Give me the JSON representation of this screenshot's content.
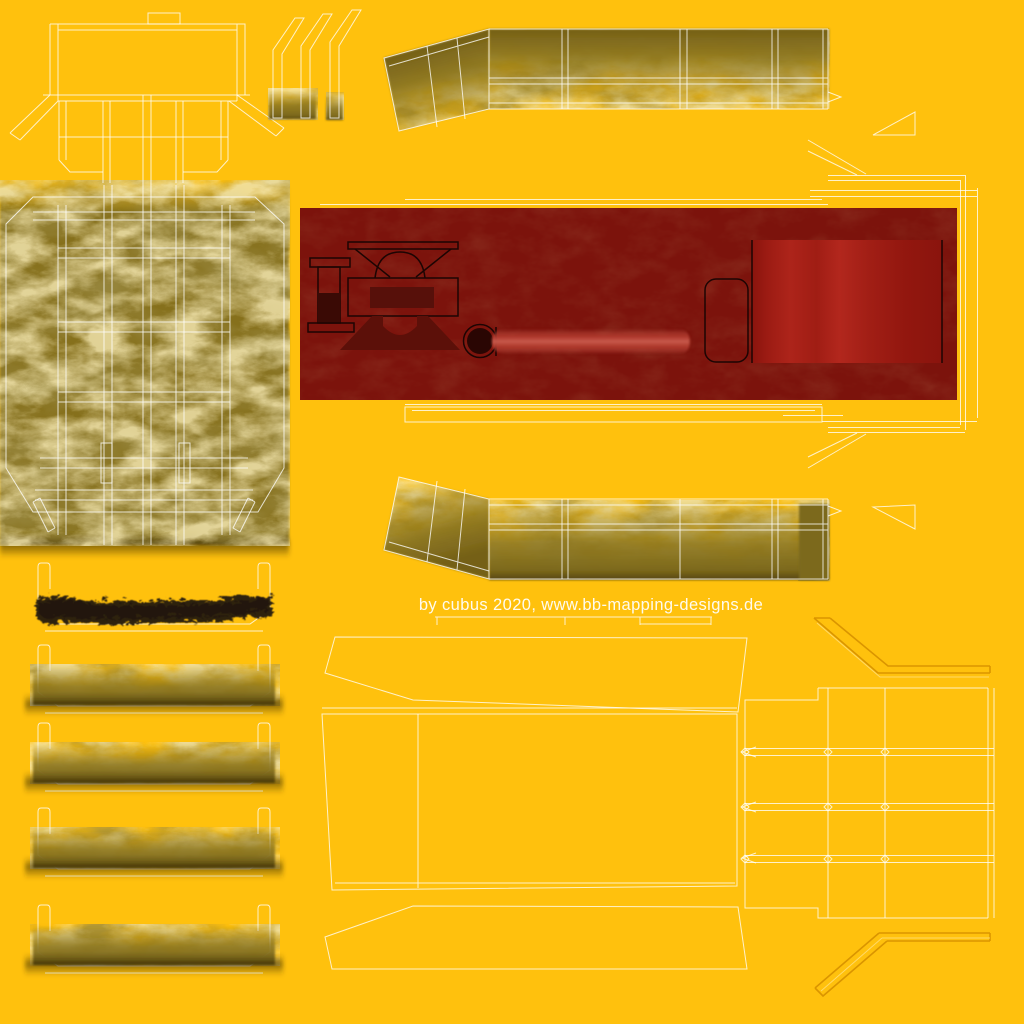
{
  "caption": {
    "text": "by cubus 2020, www.bb-mapping-designs.de"
  },
  "colors": {
    "bg": "#ffc10d",
    "outline": "#ffffff",
    "olive": "#8a741d",
    "olive_dark": "#6b5913",
    "olive_shadow": "#34280a",
    "red_base": "#7c130c",
    "red_dark": "#3f0a05",
    "red_bright": "#ad241a",
    "pipe_highlight": "#c85a4c",
    "dirt": "#2e2110",
    "emboss_dark": "#d89200",
    "emboss_light": "#ffdf80"
  },
  "islands": [
    "end-wall-template",
    "roof-profile-strips",
    "sidewall-top",
    "red-chassis-band",
    "underframe-plan",
    "sidewall-bottom",
    "plank-channels",
    "floor-template",
    "end-grid-panel"
  ]
}
